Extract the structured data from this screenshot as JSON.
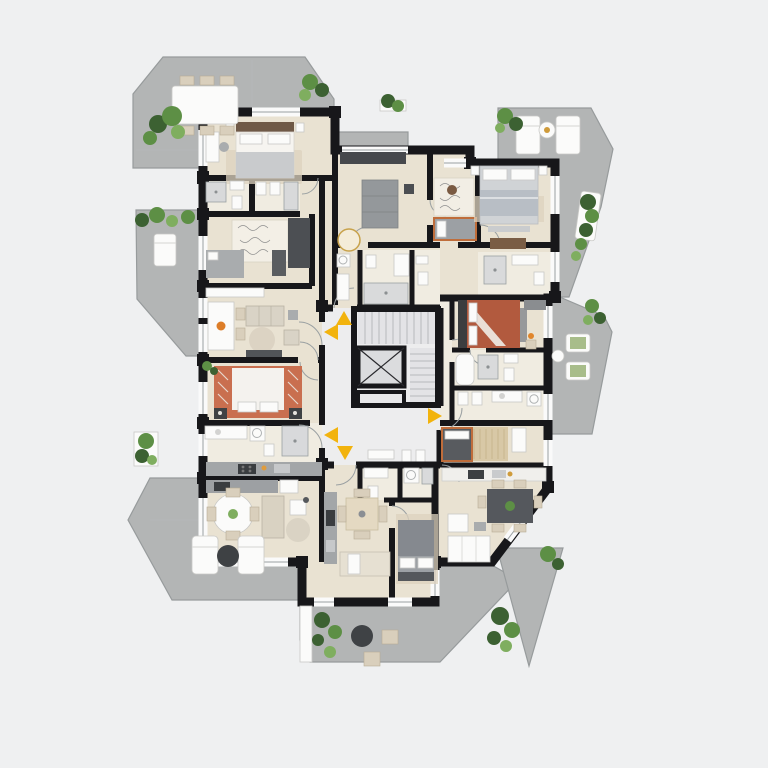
{
  "app": {
    "type": "residential-floor-plan",
    "view": "top-down-3d-render",
    "visible_text": "none"
  },
  "colors": {
    "bg": "#eff0f1",
    "wall": "#17171a",
    "floor": "#e9e2d2",
    "floor_light": "#f0ece1",
    "hall": "#ededee",
    "stair": "#e3e3e6",
    "terrace": "#b3b5b5",
    "terrace_edge": "#979b9c",
    "accent": "#f2b30d",
    "line": "#9aa0a2",
    "white_f": "#fbfbfa",
    "gray_f": "#a9acae",
    "dark_f": "#4b4e52",
    "wood": "#d9cfbc",
    "brown": "#7a5d46",
    "terra": "#b25a3e",
    "green_1": "#3c6132",
    "green_2": "#5d8f45",
    "green_3": "#7fae5f",
    "rug": "#dcd2bd",
    "tick": "#b4b7b9"
  },
  "central_core": {
    "features": [
      "staircase",
      "elevator-shaft-with-x-brace",
      "landing-hall"
    ]
  },
  "entrance_markers": {
    "color_ref": "accent",
    "items": [
      {
        "id": 1,
        "direction": "up",
        "location": "core-top-left"
      },
      {
        "id": 2,
        "direction": "left",
        "location": "core-left-upper"
      },
      {
        "id": 3,
        "direction": "right",
        "location": "core-right"
      },
      {
        "id": 4,
        "direction": "left",
        "location": "core-left-lower"
      },
      {
        "id": 5,
        "direction": "down",
        "location": "core-bottom"
      }
    ]
  },
  "terraces": [
    {
      "position": "top-left",
      "furniture": [
        "dining-table",
        "chairs",
        "potted-plants"
      ]
    },
    {
      "position": "top-right",
      "furniture": [
        "sun-lounger",
        "sun-lounger",
        "round-side-table",
        "planters"
      ]
    },
    {
      "position": "left",
      "furniture": [
        "lounger",
        "planter-row"
      ]
    },
    {
      "position": "right-middle",
      "furniture": [
        "lounge-chair",
        "lounge-chair",
        "round-side-table",
        "planters"
      ]
    },
    {
      "position": "bottom-left",
      "furniture": [
        "lounger",
        "lounger",
        "round-coffee-table",
        "planter"
      ]
    },
    {
      "position": "bottom-center",
      "furniture": [
        "round-pouf",
        "square-poufs",
        "planter-strip"
      ]
    },
    {
      "position": "bottom-right-triangle",
      "furniture": [
        "palm-plants"
      ]
    }
  ],
  "apartments": [
    {
      "position": "top-left",
      "rooms": [
        "bedroom-double",
        "bathroom",
        "bathroom",
        "study-daybed",
        "living-dining"
      ]
    },
    {
      "position": "left-middle",
      "rooms": [
        "living-dining",
        "bedroom-double-red-blanket",
        "bathroom",
        "kitchen"
      ]
    },
    {
      "position": "bottom-left",
      "rooms": [
        "kitchen",
        "living-dining-round-table"
      ]
    },
    {
      "position": "top-center",
      "rooms": [
        "living-sofa",
        "bedroom-single",
        "bathroom",
        "wc"
      ]
    },
    {
      "position": "top-right",
      "rooms": [
        "bedroom-double-gray",
        "bathroom",
        "dresser-hall"
      ]
    },
    {
      "position": "right-middle",
      "rooms": [
        "bedroom-double-terracotta",
        "bathroom-tub",
        "bathroom"
      ]
    },
    {
      "position": "bottom-right",
      "rooms": [
        "bedroom-single",
        "kitchen",
        "living-dining-six-chairs"
      ]
    },
    {
      "position": "bottom-center",
      "rooms": [
        "bathroom",
        "kitchen-strip",
        "living-dining",
        "bedroom-double-gray"
      ]
    }
  ]
}
